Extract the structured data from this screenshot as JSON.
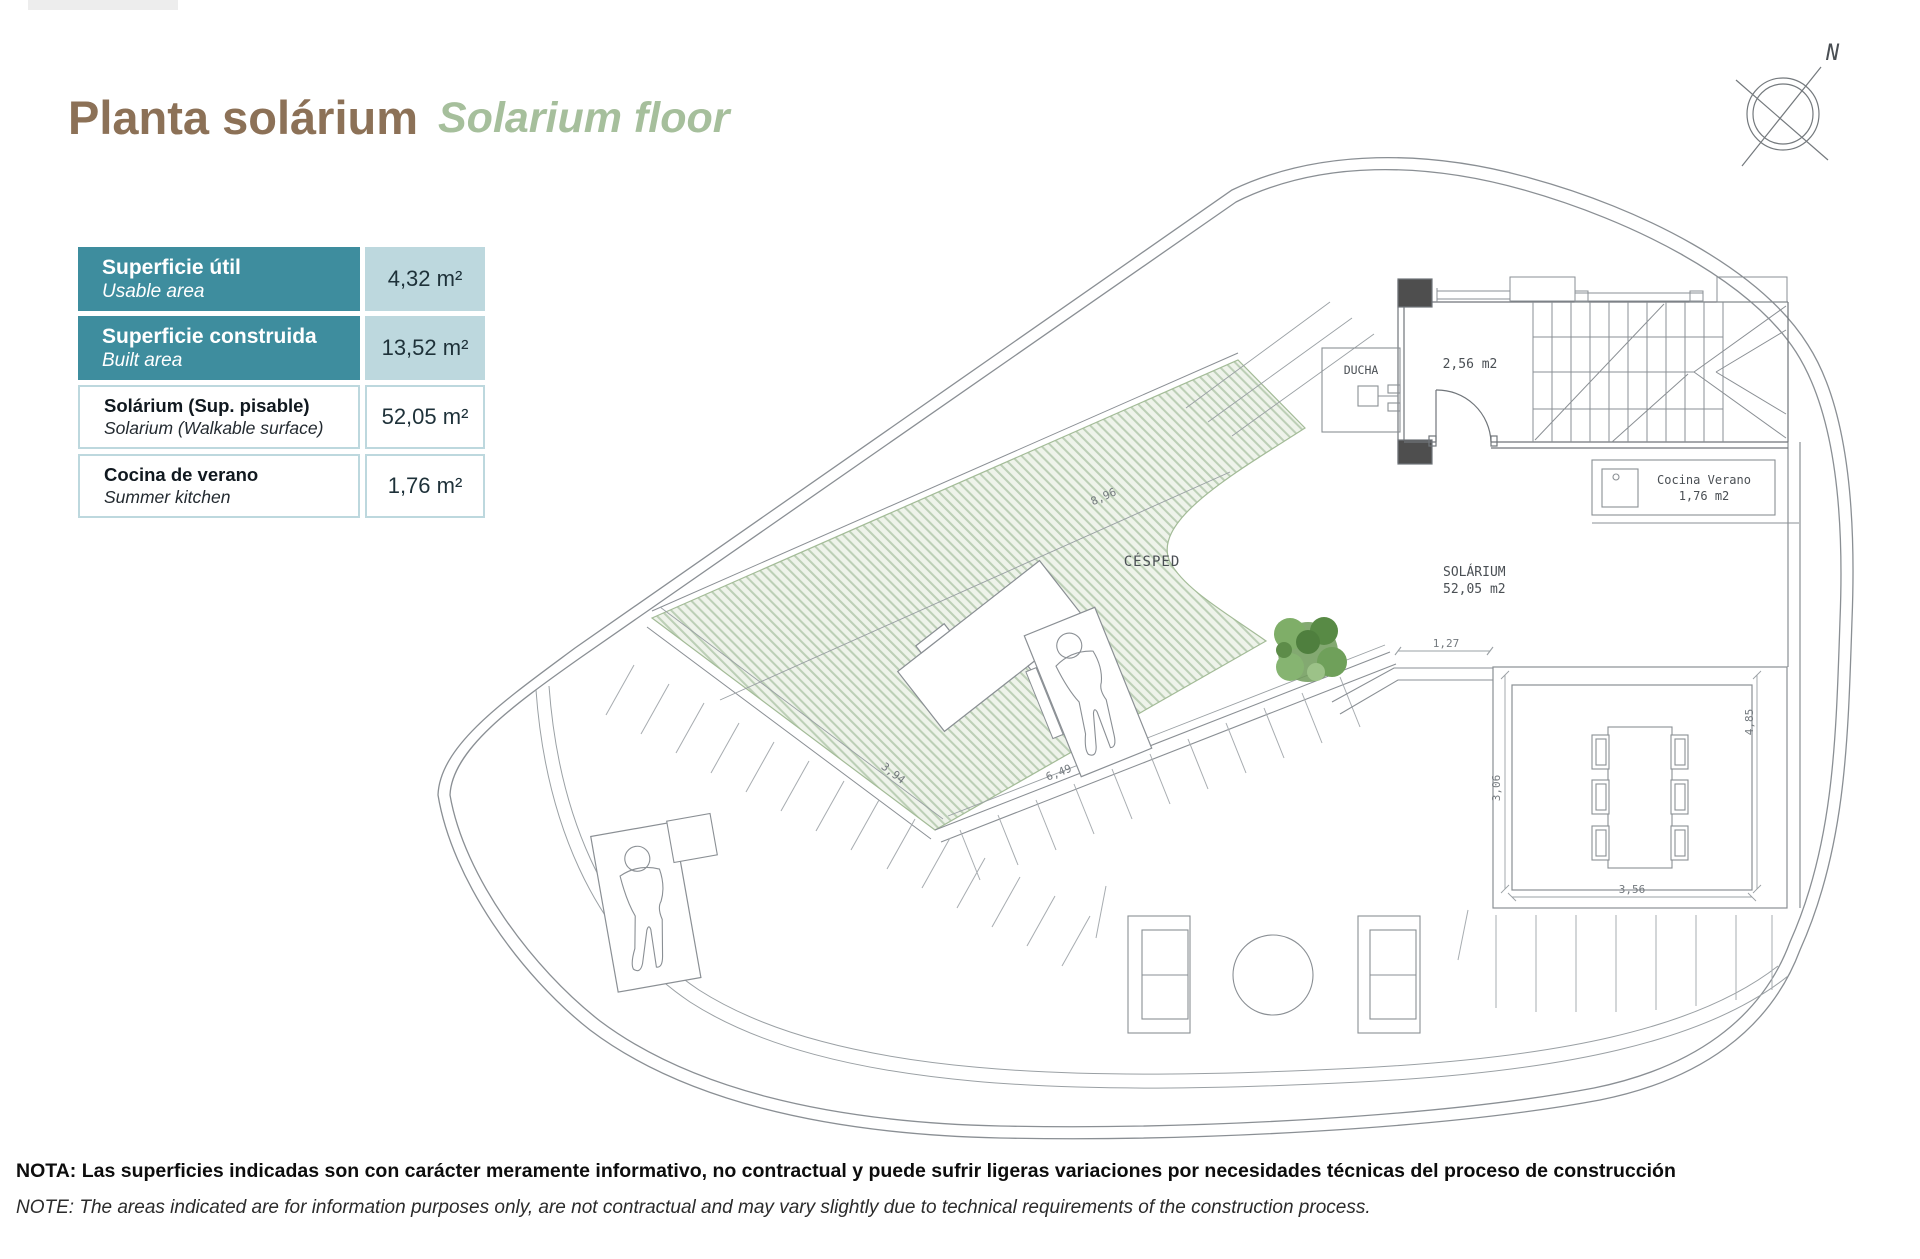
{
  "header": {
    "title_es": "Planta solárium",
    "title_en": "Solarium floor"
  },
  "areas_table": {
    "rows": [
      {
        "label_es": "Superficie útil",
        "label_en": "Usable area",
        "value": "4,32 m²"
      },
      {
        "label_es": "Superficie construida",
        "label_en": "Built area",
        "value": "13,52 m²"
      },
      {
        "label_es": "Solárium (Sup. pisable)",
        "label_en": "Solarium (Walkable surface)",
        "value": "52,05 m²"
      },
      {
        "label_es": "Cocina de verano",
        "label_en": "Summer kitchen",
        "value": "1,76 m²"
      }
    ]
  },
  "compass": {
    "north": "N"
  },
  "plan": {
    "rooms": {
      "ducha": "DUCHA",
      "stair_room_area": "2,56  m2",
      "cocina_l1": "Cocina  Verano",
      "cocina_l2": "1,76  m2",
      "solarium_l1": "SOLÁRIUM",
      "solarium_l2": "52,05  m2",
      "cesped": "CÉSPED"
    },
    "dims": {
      "top": "8,96",
      "left": "3,94",
      "bottom_diag": "6,49",
      "step": "1,27",
      "terrace_left": "3,06",
      "terrace_bottom": "3,56",
      "terrace_right": "4,85"
    }
  },
  "footer": {
    "note_es": "NOTA: Las superficies indicadas son con carácter meramente informativo, no contractual y puede sufrir ligeras variaciones por necesidades técnicas del proceso de construcción",
    "note_en": "NOTE: The areas indicated are for information purposes only, are not contractual and may vary slightly due to technical requirements of the construction process."
  },
  "colors": {
    "teal": "#3e8d9e",
    "light_blue": "#bdd8de",
    "title_brown": "#8c7157",
    "title_green": "#a6bf9c",
    "hatch_green": "#bccfb6",
    "plan_gray": "#8a8f94"
  }
}
